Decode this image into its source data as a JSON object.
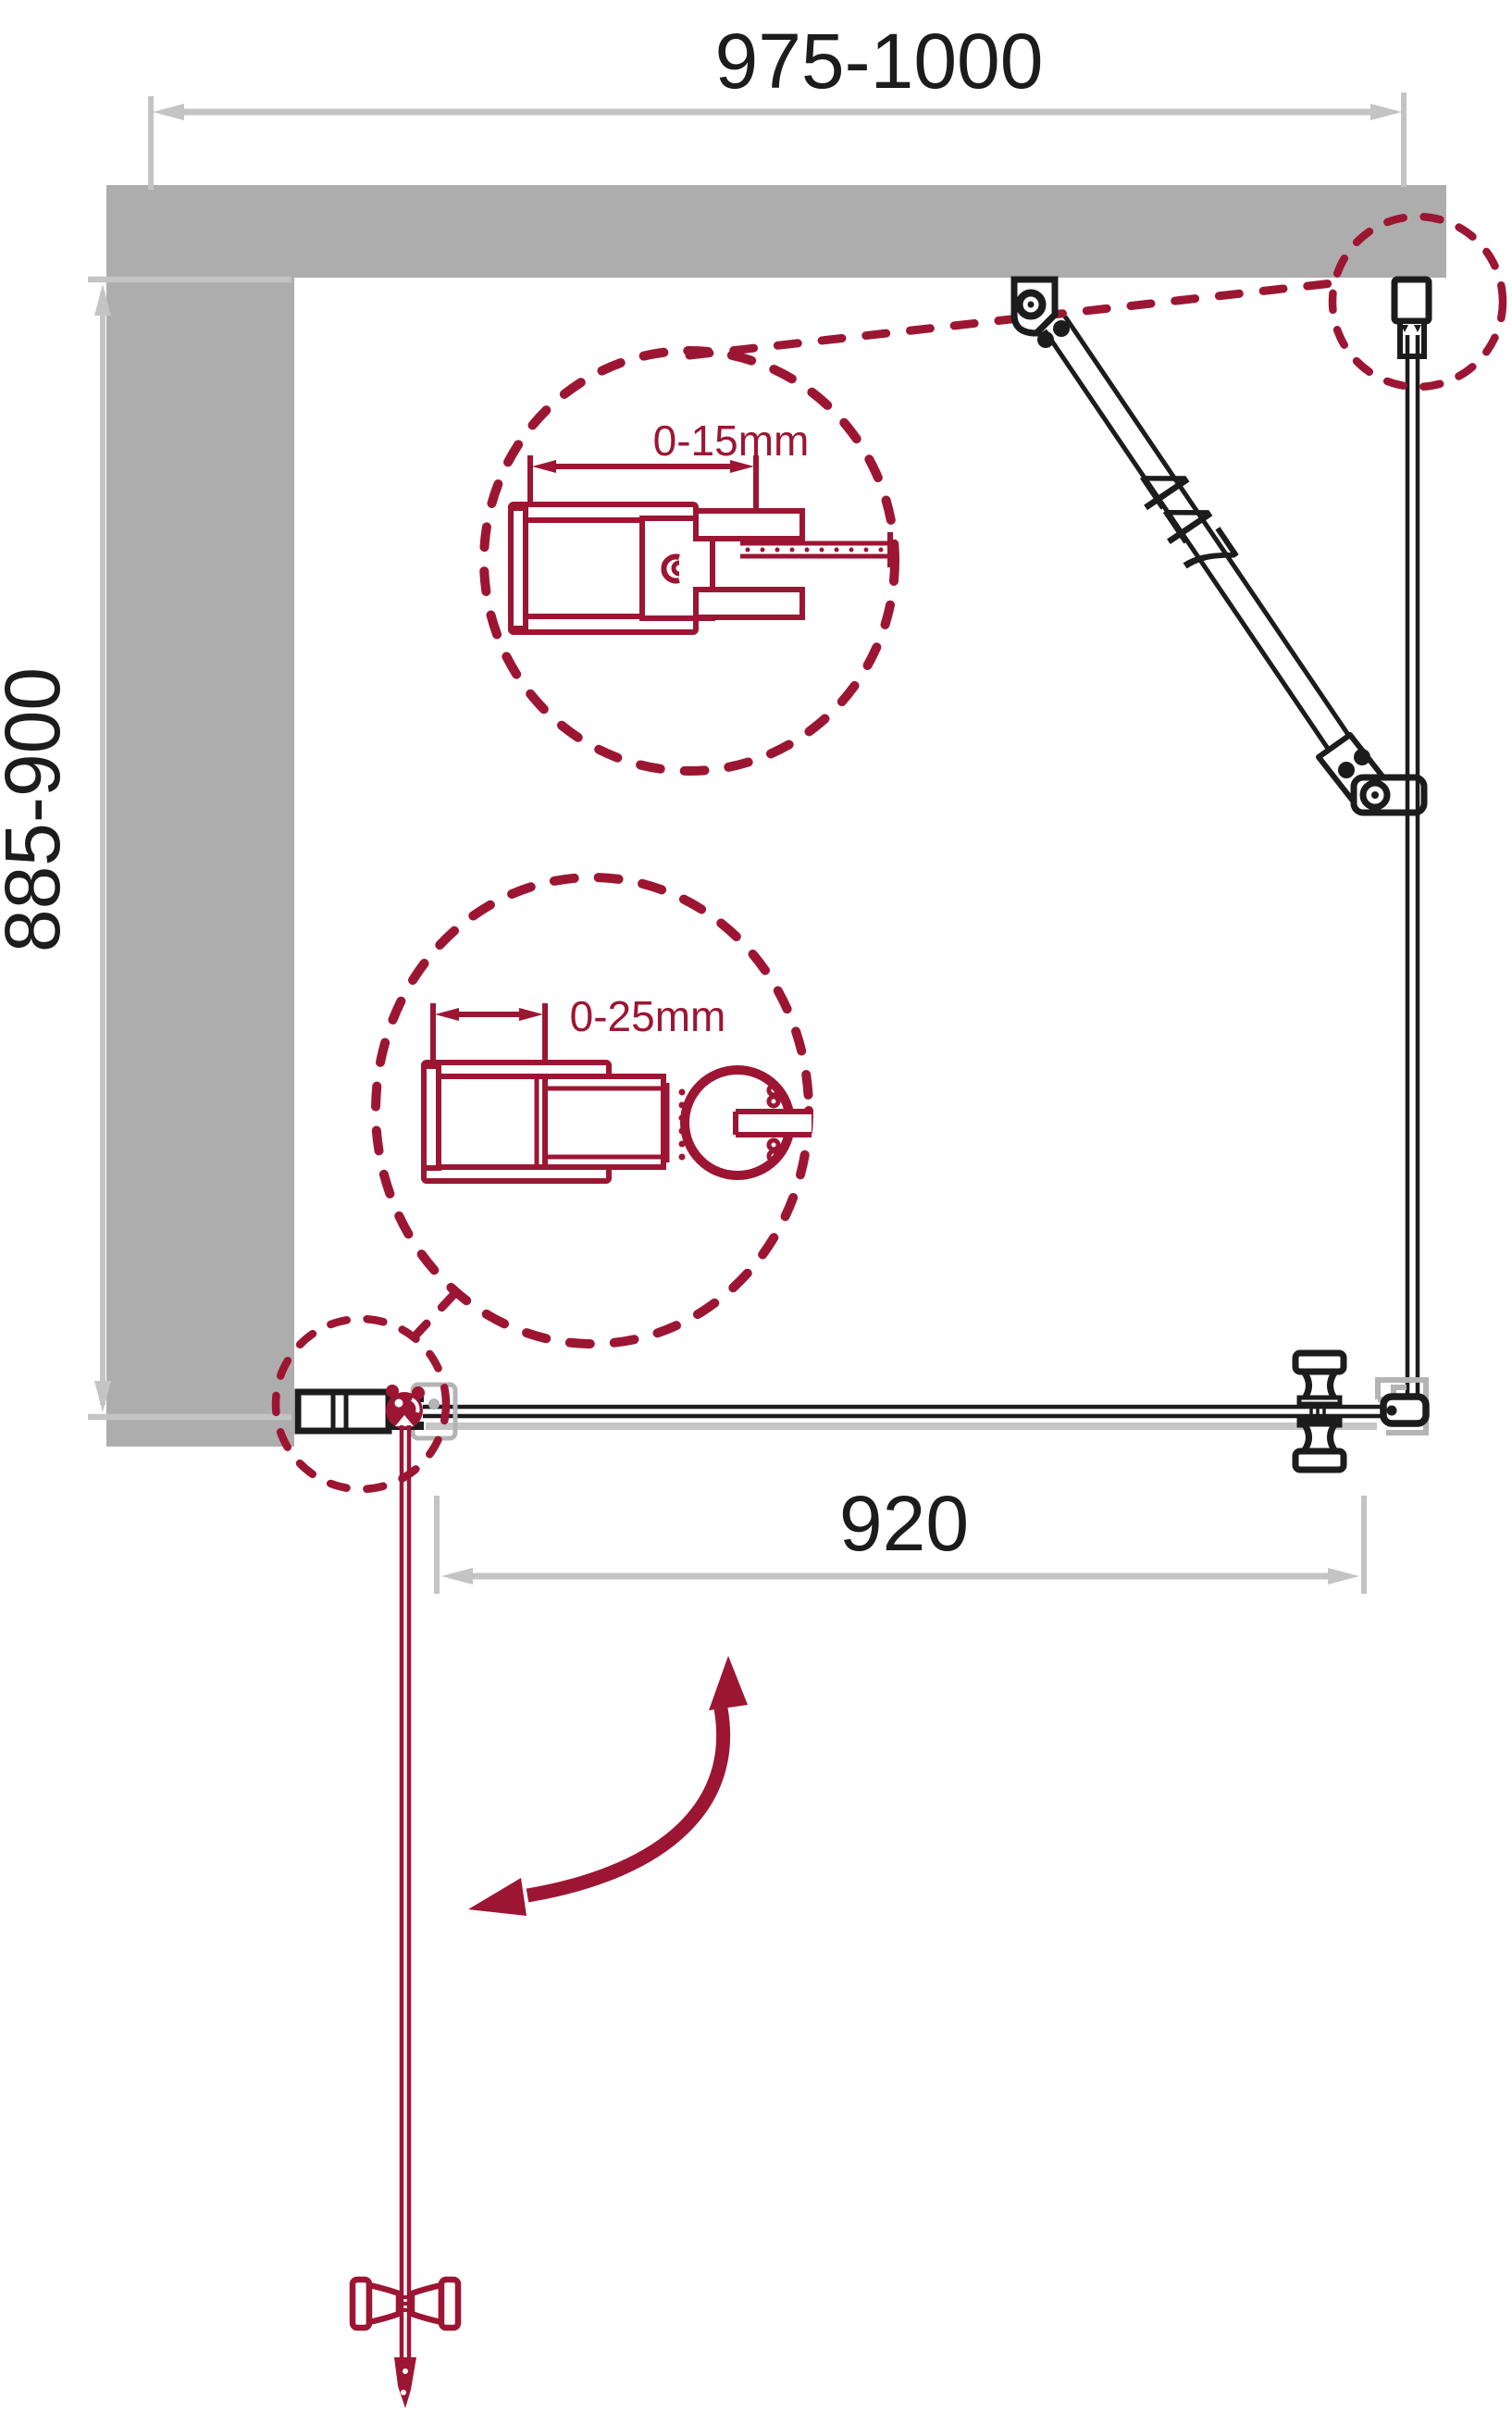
{
  "diagram": {
    "title": "shower-enclosure-installation-plan",
    "type": "technical-drawing",
    "dimensions": {
      "total_width_range": "975-1000",
      "side_depth_range": "885-900",
      "door_glass_width": "920",
      "support_bar_length": "447",
      "wall_profile_adjustment_1": "0-15mm",
      "wall_profile_adjustment_2": "0-25mm"
    },
    "colors": {
      "accent_red": "#9C1633",
      "wall_gray": "#ADADAD",
      "dimension_gray": "#C4C4C4",
      "line_black": "#1C1C1C",
      "ghost_gray": "#B4B4B4"
    }
  }
}
